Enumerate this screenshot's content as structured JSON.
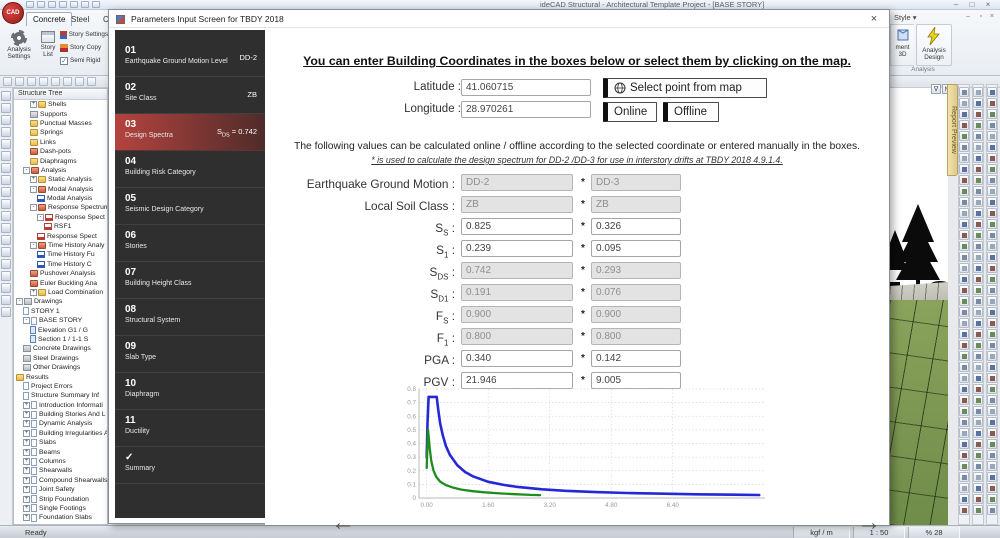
{
  "window": {
    "title": "ideCAD Structural - Architectural Template Project - [BASE STORY]",
    "controls": [
      "–",
      "□",
      "×"
    ],
    "doc_controls": [
      "–",
      "▫",
      "×"
    ]
  },
  "ribbon": {
    "tabs": [
      "Concrete",
      "Steel",
      "Co"
    ],
    "style_label": "Style",
    "left_group": {
      "label": "Project Settings",
      "analysis_settings": "Analysis Settings",
      "story_list": "Story List",
      "options": [
        "Story Settings",
        "Story Copy",
        "Semi Rigid"
      ]
    },
    "right_group": {
      "label": "Analysis",
      "analysis_design": "Analysis Design",
      "partial_button": "ment 3D"
    }
  },
  "view_buttons": [
    "∇",
    "N",
    "∆"
  ],
  "report_tab": "Report Preview",
  "structure_tree": {
    "header": "Structure Tree",
    "items": [
      {
        "label": "Shells",
        "indent": 2,
        "icon": "folder",
        "expand": "+"
      },
      {
        "label": "Supports",
        "indent": 2,
        "icon": "tool",
        "expand": ""
      },
      {
        "label": "Punctual Masses",
        "indent": 2,
        "icon": "folder",
        "expand": ""
      },
      {
        "label": "Springs",
        "indent": 2,
        "icon": "folder",
        "expand": ""
      },
      {
        "label": "Links",
        "indent": 2,
        "icon": "folder",
        "expand": ""
      },
      {
        "label": "Dash-pots",
        "indent": 2,
        "icon": "folder-red",
        "expand": ""
      },
      {
        "label": "Diaphragms",
        "indent": 2,
        "icon": "folder",
        "expand": ""
      },
      {
        "label": "Analysis",
        "indent": 1,
        "icon": "folder-red",
        "expand": "-"
      },
      {
        "label": "Static Analysis",
        "indent": 2,
        "icon": "folder",
        "expand": "+"
      },
      {
        "label": "Modal Analysis",
        "indent": 2,
        "icon": "folder-red",
        "expand": "-"
      },
      {
        "label": "Modal Analysis",
        "indent": 3,
        "icon": "chart-blue",
        "expand": ""
      },
      {
        "label": "Response Spectrum",
        "indent": 2,
        "icon": "folder-red",
        "expand": "-"
      },
      {
        "label": "Response Spect",
        "indent": 3,
        "icon": "chart-red",
        "expand": "-"
      },
      {
        "label": "RSF1",
        "indent": 4,
        "icon": "chart-red",
        "expand": ""
      },
      {
        "label": "Response Spect",
        "indent": 3,
        "icon": "chart-red",
        "expand": ""
      },
      {
        "label": "Time History Analy",
        "indent": 2,
        "icon": "folder-red",
        "expand": "-"
      },
      {
        "label": "Time History Fu",
        "indent": 3,
        "icon": "chart-blue",
        "expand": ""
      },
      {
        "label": "Time History C",
        "indent": 3,
        "icon": "chart-blue",
        "expand": ""
      },
      {
        "label": "Pushover Analysis",
        "indent": 2,
        "icon": "folder-red",
        "expand": ""
      },
      {
        "label": "Euler Buckling Ana",
        "indent": 2,
        "icon": "folder-red",
        "expand": ""
      },
      {
        "label": "Load Combination",
        "indent": 2,
        "icon": "folder",
        "expand": "+"
      },
      {
        "label": "Drawings",
        "indent": 0,
        "icon": "tool",
        "expand": "-"
      },
      {
        "label": "STORY 1",
        "indent": 1,
        "icon": "page",
        "expand": ""
      },
      {
        "label": "BASE STORY",
        "indent": 1,
        "icon": "page",
        "expand": "-"
      },
      {
        "label": "Elevation G1 / G",
        "indent": 2,
        "icon": "page-blue",
        "expand": ""
      },
      {
        "label": "Section 1 / 1-1 S",
        "indent": 2,
        "icon": "page-blue",
        "expand": ""
      },
      {
        "label": "Concrete Drawings",
        "indent": 1,
        "icon": "tool",
        "expand": ""
      },
      {
        "label": "Steel Drawings",
        "indent": 1,
        "icon": "tool",
        "expand": ""
      },
      {
        "label": "Other Drawings",
        "indent": 1,
        "icon": "tool",
        "expand": ""
      },
      {
        "label": "Results",
        "indent": 0,
        "icon": "folder",
        "expand": ""
      },
      {
        "label": "Project Errors",
        "indent": 1,
        "icon": "page",
        "expand": ""
      },
      {
        "label": "Structure Summary Inf",
        "indent": 1,
        "icon": "page",
        "expand": ""
      },
      {
        "label": "Introduction Informati",
        "indent": 1,
        "icon": "page",
        "expand": "+"
      },
      {
        "label": "Building Stories And L",
        "indent": 1,
        "icon": "page",
        "expand": "+"
      },
      {
        "label": "Dynamic Analysis",
        "indent": 1,
        "icon": "page",
        "expand": "+"
      },
      {
        "label": "Building Irregularities A",
        "indent": 1,
        "icon": "page",
        "expand": "+"
      },
      {
        "label": "Slabs",
        "indent": 1,
        "icon": "page",
        "expand": "+"
      },
      {
        "label": "Beams",
        "indent": 1,
        "icon": "page",
        "expand": "+"
      },
      {
        "label": "Columns",
        "indent": 1,
        "icon": "page",
        "expand": "+"
      },
      {
        "label": "Shearwalls",
        "indent": 1,
        "icon": "page",
        "expand": "+"
      },
      {
        "label": "Compound Shearwalls",
        "indent": 1,
        "icon": "page",
        "expand": "+"
      },
      {
        "label": "Joint Safety",
        "indent": 1,
        "icon": "page",
        "expand": "+"
      },
      {
        "label": "Strip Foundation",
        "indent": 1,
        "icon": "page",
        "expand": "+"
      },
      {
        "label": "Single Footings",
        "indent": 1,
        "icon": "page",
        "expand": "+"
      },
      {
        "label": "Foundation Slabs",
        "indent": 1,
        "icon": "page",
        "expand": "+"
      }
    ]
  },
  "status": {
    "ready": "Ready",
    "units": "kgf / m",
    "scale": "1 : 50",
    "zoom": "% 28"
  },
  "dialog": {
    "title": "Parameters Input Screen for TBDY 2018",
    "close": "×",
    "sidebar": [
      {
        "num": "01",
        "label": "Earthquake Ground Motion Level",
        "value": "DD-2"
      },
      {
        "num": "02",
        "label": "Site Class",
        "value": "ZB"
      },
      {
        "num": "03",
        "label": "Design Spectra",
        "value_pre": "S",
        "value_sub": "DS",
        "value_post": " = 0.742",
        "selected": true
      },
      {
        "num": "04",
        "label": "Building Risk Category"
      },
      {
        "num": "05",
        "label": "Seismic Design Category"
      },
      {
        "num": "06",
        "label": "Stories"
      },
      {
        "num": "07",
        "label": "Building Height Class"
      },
      {
        "num": "08",
        "label": "Structural System"
      },
      {
        "num": "09",
        "label": "Slab Type"
      },
      {
        "num": "10",
        "label": "Diaphragm"
      },
      {
        "num": "11",
        "label": "Ductility"
      },
      {
        "num": "✓",
        "label": "Summary"
      }
    ],
    "heading": "You can enter Building Coordinates in the boxes below or select them by clicking on the map.",
    "latitude_label": "Latitude :",
    "latitude": "41.060715",
    "longitude_label": "Longitude :",
    "longitude": "28.970261",
    "map_button": "Select point from map",
    "online_button": "Online",
    "offline_button": "Offline",
    "note1": "The following values can be calculated online / offline according to the selected coordinate or entered manually in the boxes.",
    "note2": "* is used to calculate the design spectrum for DD-2 /DD-3 for use in interstory drifts at TBDY 2018 4.9.1.4.",
    "colon": " :",
    "star": "*",
    "params": [
      {
        "pre": "Earthquake Ground Motion",
        "sub": "",
        "v1": "DD-2",
        "v2": "DD-3",
        "disabled": true
      },
      {
        "pre": "Local Soil Class",
        "sub": "",
        "v1": "ZB",
        "v2": "ZB",
        "disabled": true
      },
      {
        "pre": "S",
        "sub": "S",
        "v1": "0.825",
        "v2": "0.326",
        "disabled": false
      },
      {
        "pre": "S",
        "sub": "1",
        "v1": "0.239",
        "v2": "0.095",
        "disabled": false
      },
      {
        "pre": "S",
        "sub": "DS",
        "v1": "0.742",
        "v2": "0.293",
        "disabled": true
      },
      {
        "pre": "S",
        "sub": "D1",
        "v1": "0.191",
        "v2": "0.076",
        "disabled": true
      },
      {
        "pre": "F",
        "sub": "S",
        "v1": "0.900",
        "v2": "0.900",
        "disabled": true
      },
      {
        "pre": "F",
        "sub": "1",
        "v1": "0.800",
        "v2": "0.800",
        "disabled": true
      },
      {
        "pre": "PGA",
        "sub": "",
        "v1": "0.340",
        "v2": "0.142",
        "disabled": false
      },
      {
        "pre": "PGV",
        "sub": "",
        "v1": "21.946",
        "v2": "9.005",
        "disabled": false
      }
    ],
    "back_arrow": "←",
    "next_arrow": "→"
  },
  "chart_data": {
    "type": "line",
    "title": "",
    "xlabel": "",
    "ylabel": "",
    "xlim": [
      -0.2,
      8.8
    ],
    "ylim": [
      0,
      0.8
    ],
    "xticks": [
      0.0,
      1.6,
      3.2,
      4.8,
      6.4
    ],
    "xtick_labels": [
      "0.00",
      "1.60",
      "3.20",
      "4.80",
      "6.40"
    ],
    "yticks": [
      0,
      0.1,
      0.2,
      0.3,
      0.4,
      0.5,
      0.6,
      0.7,
      0.8
    ],
    "grid": true,
    "legend": "none",
    "series": [
      {
        "name": "Design spectrum DD-2 (SDS=0.742, SD1=0.191)",
        "color": "#2428d8",
        "width": 2.6,
        "points": [
          [
            0,
            0.297
          ],
          [
            0.02,
            0.55
          ],
          [
            0.05,
            0.742
          ],
          [
            0.26,
            0.742
          ],
          [
            0.3,
            0.65
          ],
          [
            0.35,
            0.55
          ],
          [
            0.42,
            0.46
          ],
          [
            0.5,
            0.382
          ],
          [
            0.6,
            0.318
          ],
          [
            0.8,
            0.239
          ],
          [
            1.0,
            0.191
          ],
          [
            1.2,
            0.159
          ],
          [
            1.6,
            0.119
          ],
          [
            2.0,
            0.096
          ],
          [
            2.4,
            0.08
          ],
          [
            3.0,
            0.064
          ],
          [
            3.6,
            0.053
          ],
          [
            4.4,
            0.043
          ],
          [
            5.2,
            0.037
          ],
          [
            6.0,
            0.032
          ],
          [
            7.0,
            0.027
          ],
          [
            8.0,
            0.024
          ],
          [
            8.65,
            0.022
          ]
        ]
      },
      {
        "name": "Design spectrum DD-3 (SDS=0.293, SD1=0.076)",
        "color": "#1f8c1f",
        "width": 2.3,
        "points": [
          [
            0,
            0.22
          ],
          [
            0.02,
            0.4
          ],
          [
            0.035,
            0.5
          ],
          [
            0.05,
            0.46
          ],
          [
            0.08,
            0.36
          ],
          [
            0.12,
            0.27
          ],
          [
            0.18,
            0.2
          ],
          [
            0.25,
            0.155
          ],
          [
            0.35,
            0.12
          ],
          [
            0.5,
            0.095
          ],
          [
            0.7,
            0.075
          ],
          [
            0.9,
            0.062
          ],
          [
            1.2,
            0.05
          ],
          [
            1.5,
            0.042
          ],
          [
            1.9,
            0.034
          ],
          [
            2.3,
            0.028
          ],
          [
            2.7,
            0.023
          ],
          [
            2.95,
            0.021
          ]
        ]
      }
    ]
  },
  "decor": {
    "left_strip_count": 19,
    "right_column_cells": 39
  }
}
